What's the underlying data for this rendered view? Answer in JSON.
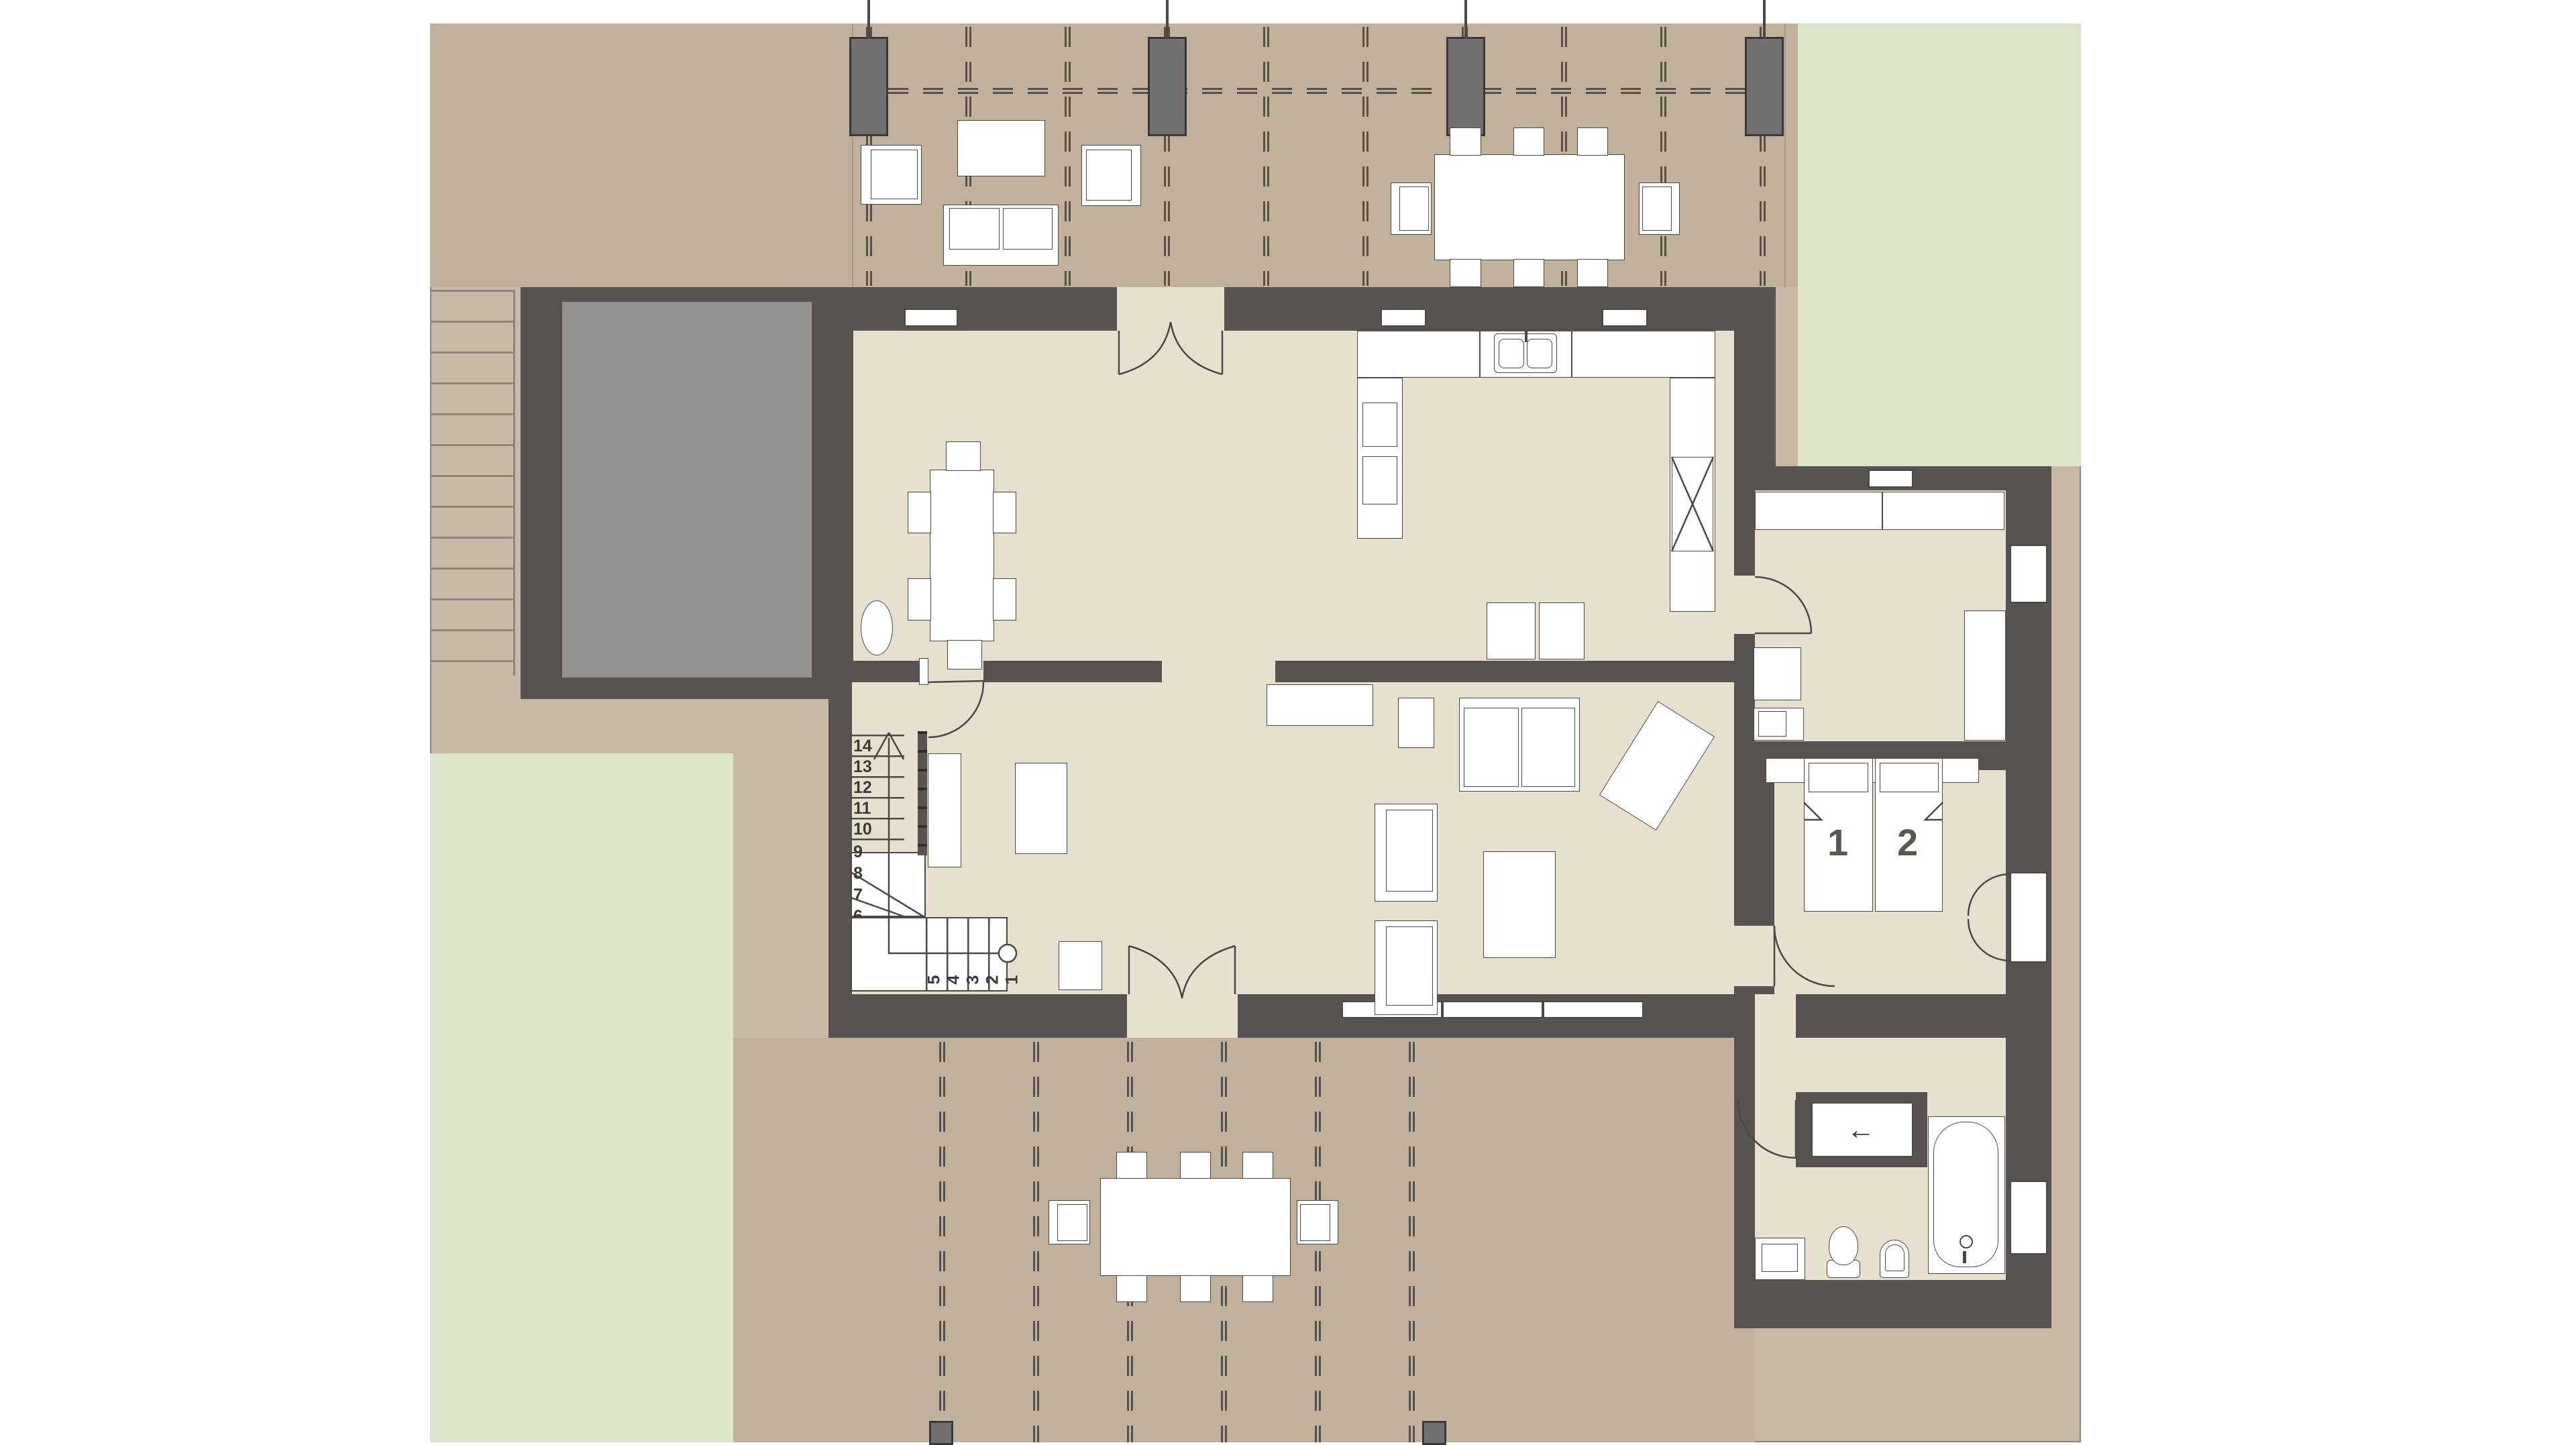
{
  "colors": {
    "wall": "#585350",
    "floor": "#e8e0cf",
    "ground": "#c7b9a5",
    "ground_dark": "#c1b09a",
    "green": "#dbe5ca",
    "garage": "#949192",
    "line": "#4c4843",
    "dash": "#55504b",
    "label": "#5b5650"
  },
  "bedroom": {
    "bed_labels": [
      "1",
      "2"
    ]
  },
  "bathroom": {
    "closet_arrow": "←"
  },
  "stairs": {
    "upper_numbers": [
      "14",
      "13",
      "12",
      "11",
      "10"
    ],
    "winder_numbers": [
      "9",
      "8",
      "7",
      "6"
    ],
    "lower_numbers": [
      "5",
      "4",
      "3",
      "2",
      "1"
    ]
  }
}
